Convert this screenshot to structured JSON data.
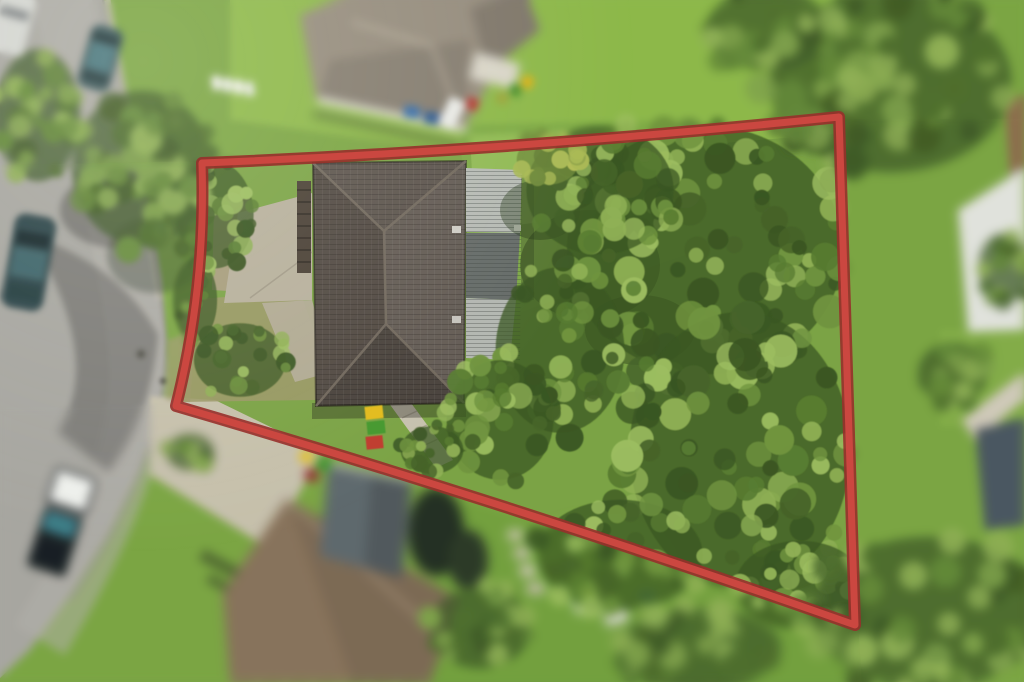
{
  "scene": {
    "type": "aerial-drone-photo",
    "subject": "residential block outlined with red property-boundary overlay, house at front and dense tree canopy at rear",
    "view": "top-down",
    "effects": {
      "focus": "inside boundary sharp",
      "tilt_shift_blur": "surroundings blurred"
    },
    "boundary": {
      "stroke_color": "#cb4740",
      "outline_color": "#97302b",
      "corners_px": [
        [
          202,
          163
        ],
        [
          839,
          117
        ],
        [
          855,
          625
        ],
        [
          176,
          406
        ]
      ]
    },
    "property": {
      "main_house_roof_color": "#574f47",
      "main_house_roof_type": "dark tiled hip roof",
      "carport_roof_light_color": "#b7bbb5",
      "carport_roof_dark_color": "#666c69",
      "driveway_color": "#b7b09c",
      "path_color": "#c7c2af",
      "dry_grass_color": "#9b9766",
      "wheelie_bins": [
        {
          "name": "yellow-bin",
          "hex": "#e3bc1e"
        },
        {
          "name": "green-bin",
          "hex": "#44982f"
        },
        {
          "name": "red-bin",
          "hex": "#bf3a2f"
        }
      ]
    },
    "surroundings": {
      "road_color": "#a6a59f",
      "grass_color": "#7ba345",
      "driveway_apron_color": "#c6c0ac",
      "vehicles": [
        {
          "name": "teal-sedan-top",
          "hex": "#355257"
        },
        {
          "name": "dark-sedan-middle",
          "hex": "#2a4346"
        },
        {
          "name": "utility-truck-bottom",
          "hex": "#343b3d"
        },
        {
          "name": "white-car-top",
          "hex": "#e9eae6"
        }
      ],
      "neighbor_roofs": [
        {
          "position": "top",
          "hex": "#948b7d"
        },
        {
          "position": "bottom",
          "hex": "#8d7962"
        },
        {
          "position": "right-white",
          "hex": "#e9eae4"
        },
        {
          "position": "bottom-right",
          "hex": "#49565e"
        }
      ]
    }
  }
}
